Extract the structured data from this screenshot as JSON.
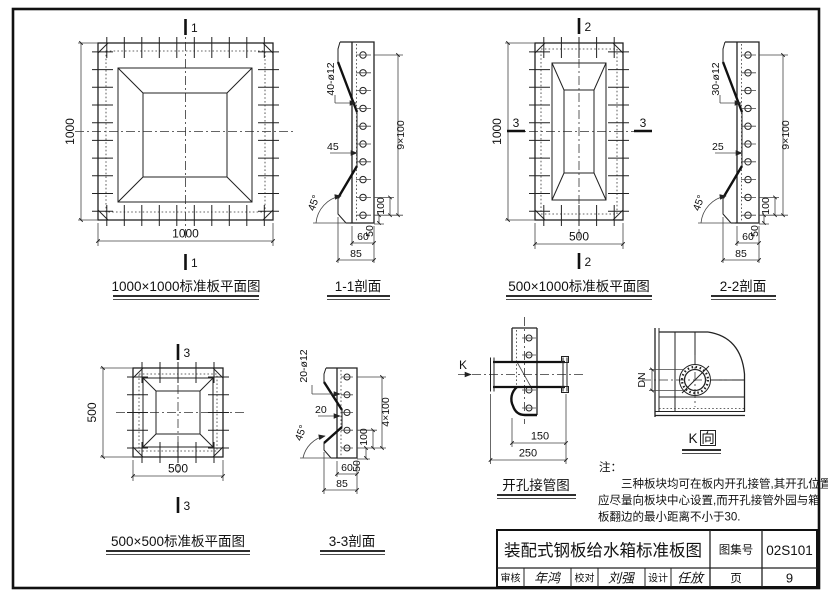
{
  "plan_1000": {
    "title": "1000×1000标准板平面图",
    "dim_left": "1000",
    "dim_bottom": "1000",
    "mark_top": "1",
    "mark_bottom": "1"
  },
  "section_1_1": {
    "title": "1-1剖面",
    "holes": "40-ø12",
    "offset": "45",
    "pitch": "9×100",
    "d100": "100",
    "d50": "50",
    "d60": "60",
    "d85": "85",
    "angle": "45°"
  },
  "plan_500_1000": {
    "title": "500×1000标准板平面图",
    "dim_left": "1000",
    "dim_bottom": "500",
    "mark_top": "2",
    "mark_bottom": "2",
    "mark_left": "3",
    "mark_right": "3"
  },
  "section_2_2": {
    "title": "2-2剖面",
    "holes": "30-ø12",
    "offset": "25",
    "pitch": "9×100",
    "d100": "100",
    "d50": "50",
    "d60": "60",
    "d85": "85",
    "angle": "45°"
  },
  "plan_500": {
    "title": "500×500标准板平面图",
    "dim_left": "500",
    "dim_bottom": "500",
    "mark_top": "3",
    "mark_bottom": "3"
  },
  "section_3_3": {
    "title": "3-3剖面",
    "holes": "20-ø12",
    "offset": "20",
    "pitch": "4×100",
    "d100": "100",
    "d50": "50",
    "d60": "60",
    "d85": "85",
    "angle": "45°"
  },
  "pipe_detail": {
    "title": "开孔接管图",
    "k": "K",
    "d150": "150",
    "d250": "250"
  },
  "k_view": {
    "k": "K",
    "dir": "向",
    "dn": "DN"
  },
  "note": {
    "label": "注：",
    "line1": "三种板块均可在板内开孔接管,其开孔位置",
    "line2": "应尽量向板块中心设置,而开孔接管外园与箱",
    "line3": "板翻边的最小距离不小于30."
  },
  "title_block": {
    "title": "装配式钢板给水箱标准板图",
    "atlas_label": "图集号",
    "atlas_no": "02S101",
    "page_label": "页",
    "page_no": "9",
    "review_label": "审核",
    "review_sig": "年鸿",
    "check_label": "校对",
    "check_sig": "刘强",
    "design_label": "设计",
    "design_sig": "任放"
  }
}
